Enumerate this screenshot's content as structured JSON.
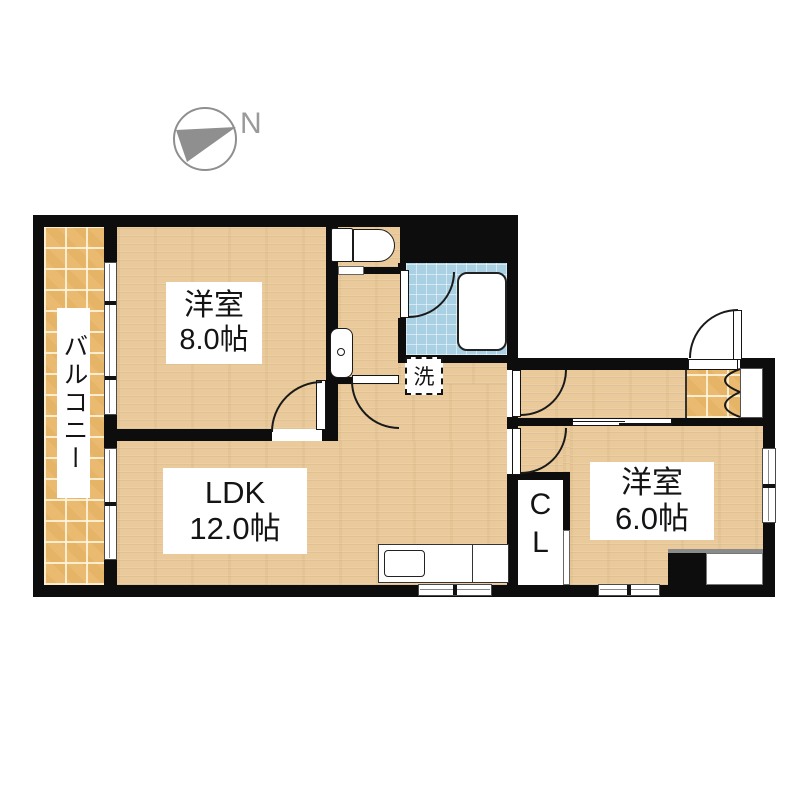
{
  "compass": {
    "label": "N"
  },
  "rooms": {
    "bedroom_8": {
      "name": "洋室",
      "size": "8.0帖"
    },
    "ldk": {
      "name": "LDK",
      "size": "12.0帖"
    },
    "bedroom_6": {
      "name": "洋室",
      "size": "6.0帖"
    },
    "balcony": {
      "name": "バルコニー"
    },
    "closet": {
      "abbr_line1": "C",
      "abbr_line2": "L"
    },
    "laundry": {
      "label": "洗"
    }
  },
  "icons": {
    "compass": "compass-circle-with-north-arrow",
    "toilet": "toilet-icon",
    "vanity": "washbasin-icon",
    "bathtub": "bathtub-icon",
    "kitchen": "kitchen-counter-with-sink",
    "washer": "washing-machine-pan-dashed-box"
  },
  "colors": {
    "wall": "#0d0d0d",
    "wood_floor": "#eaca9b",
    "balcony_tile": "#eaba70",
    "bath_tile": "#a9d0e3",
    "label_text": "#141414",
    "compass_gray": "#8f8f8f"
  }
}
